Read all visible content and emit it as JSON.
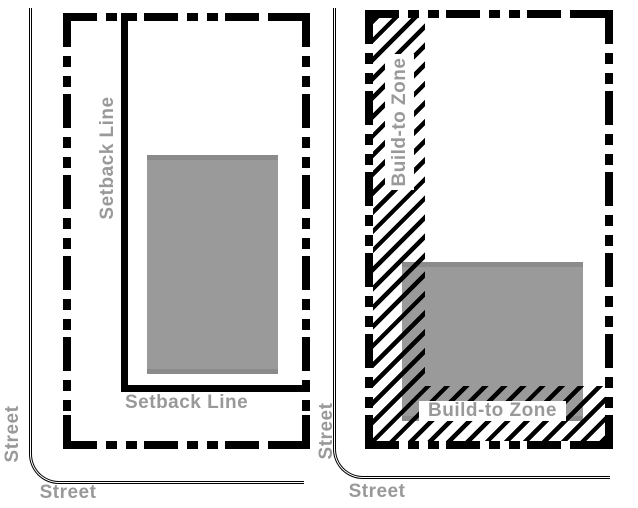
{
  "left_diagram": {
    "setback_label_vertical": "Setback Line",
    "setback_label_horizontal": "Setback Line",
    "street_label_vertical": "Street",
    "street_label_horizontal": "Street"
  },
  "right_diagram": {
    "zone_label_vertical": "Build-to Zone",
    "zone_label_horizontal": "Build-to Zone",
    "street_label_vertical": "Street",
    "street_label_horizontal": "Street"
  },
  "colors": {
    "boundary_line": "#000000",
    "label_text": "#999999",
    "building_fill": "#9a9a9a",
    "building_edge": "#8b8b8b",
    "background": "#ffffff"
  }
}
